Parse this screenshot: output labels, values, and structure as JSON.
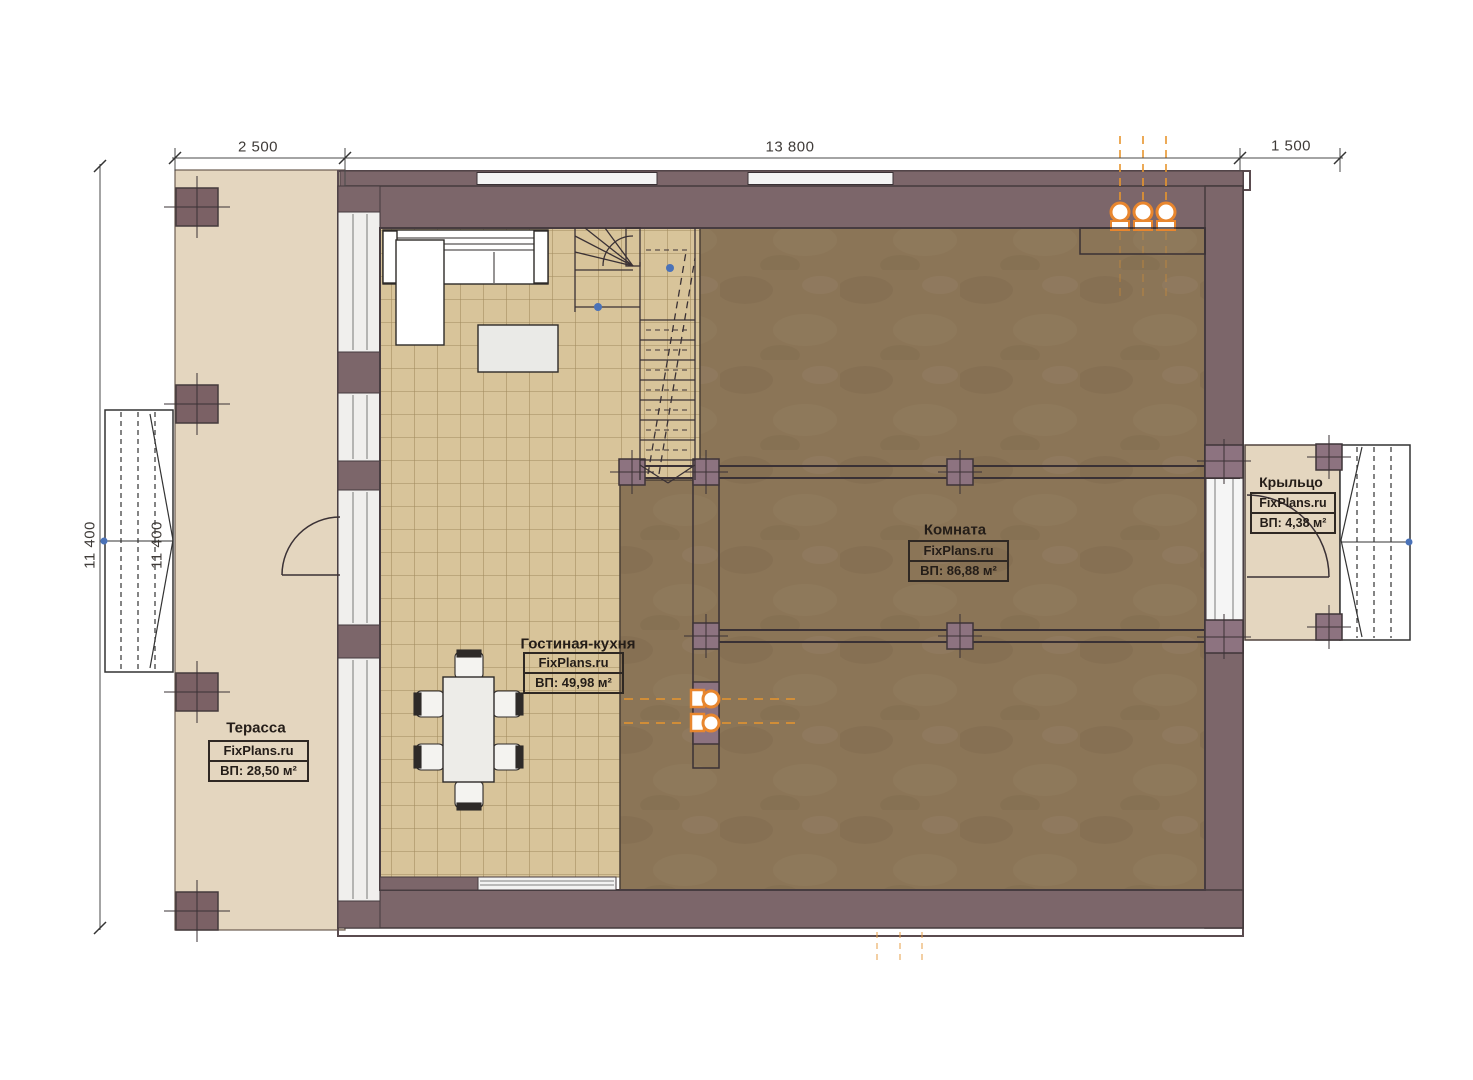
{
  "plan": {
    "dimensions": {
      "top_1": "2 500",
      "top_2": "13 800",
      "top_3": "1 500",
      "left_1": "11 400",
      "left_2": "11 400"
    },
    "rooms": {
      "terrace": {
        "name": "Терасса",
        "brand": "FixPlans.ru",
        "area": "ВП: 28,50 м²"
      },
      "living": {
        "name": "Гостиная-кухня",
        "brand": "FixPlans.ru",
        "area": "ВП: 49,98 м²"
      },
      "room": {
        "name": "Комната",
        "brand": "FixPlans.ru",
        "area": "ВП: 86,88 м²"
      },
      "porch": {
        "name": "Крыльцо",
        "brand": "FixPlans.ru",
        "area": "ВП: 4,38 м²"
      }
    },
    "colors": {
      "wall": "#7c666a",
      "wall_dark": "#443a3d",
      "column": "#8d7380",
      "terrace_floor": "#e4d6bf",
      "tile_floor": "#d8c49a",
      "tile_line": "#a18a5d",
      "dark_floor": "#8b7557",
      "accent_orange": "#e8862e",
      "marker_blue": "#4a72b8",
      "drawing_line": "#3a3135"
    }
  }
}
